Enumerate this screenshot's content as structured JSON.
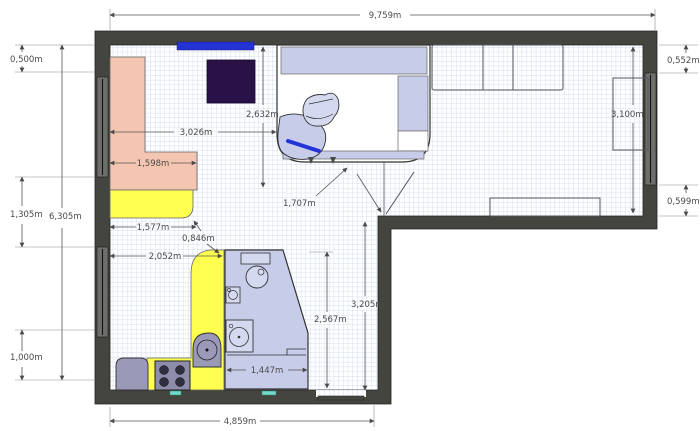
{
  "dims": {
    "width_top": "9,759m",
    "left_top": "0,500m",
    "left_mid": "1,305m",
    "left_total": "6,305m",
    "left_bottom": "1,000m",
    "right_top": "0,552m",
    "room_height": "3,100m",
    "right_bottom": "0,599m",
    "wall_to_loggia": "3,026m",
    "loggia_depth": "2,632m",
    "sofa_width": "1,598m",
    "counter_width": "1,577m",
    "gap_diagonal": "0,846m",
    "kitchen_width": "2,052m",
    "passage_diagonal": "1,707m",
    "lower_room_height": "3,205m",
    "bath_height": "2,567m",
    "bath_width": "1,447m",
    "width_bottom": "4,859m"
  },
  "colors": {
    "wall": "#454540",
    "window": "#6e6e6a",
    "grid_line": "#c9d3e6",
    "lavender": "#c7cce9",
    "lavender_light": "#d4d9f0",
    "salmon": "#f4c6b1",
    "yellow": "#ffff4f",
    "appliance_gray": "#9b99b8",
    "burner": "#2e2e40",
    "dark_table": "#2a1147",
    "blue_accent": "#2433d6",
    "teal": "#72d9c8",
    "white": "#ffffff"
  }
}
